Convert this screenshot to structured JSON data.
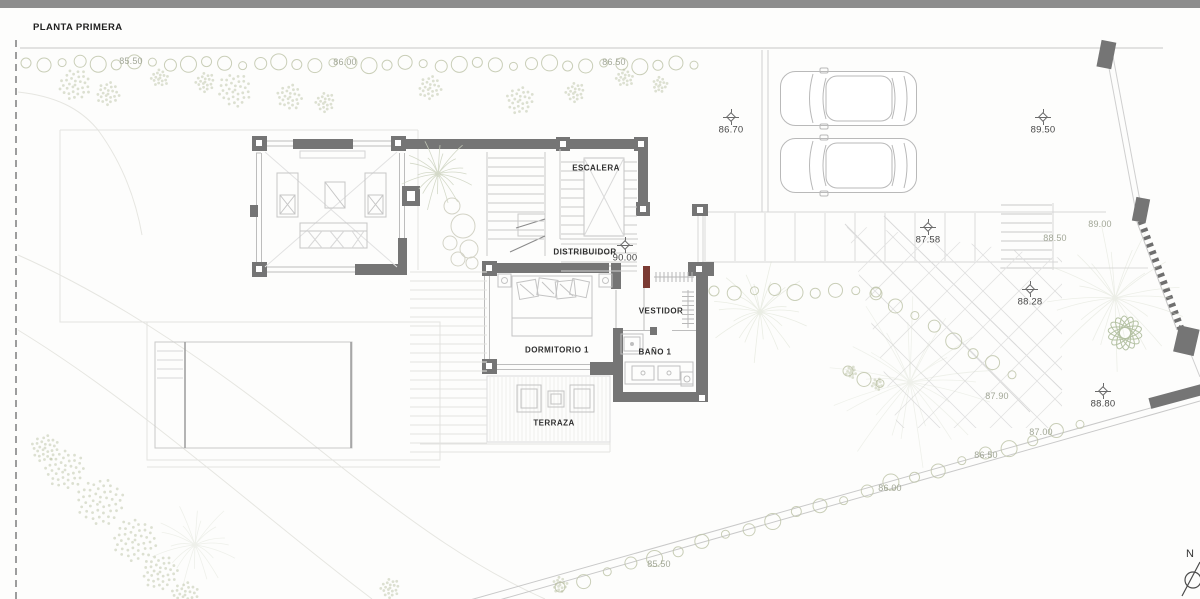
{
  "page": {
    "title": "PLANTA PRIMERA"
  },
  "compass": {
    "label": "N"
  },
  "colors": {
    "topbar": "#8d8d8d",
    "wall": "#757575",
    "thin_line": "#c9c9c9",
    "vegetation": "#b9c0a3",
    "wardrobe_accent": "#7b3b33",
    "label_dark": "#474747",
    "label_light": "#a2a797"
  },
  "rooms": [
    {
      "id": "escalera",
      "label": "ESCALERA",
      "x": 596,
      "y": 168
    },
    {
      "id": "distribuidor",
      "label": "DISTRIBUIDOR",
      "x": 585,
      "y": 252
    },
    {
      "id": "dormitorio-1",
      "label": "DORMITORIO 1",
      "x": 557,
      "y": 350
    },
    {
      "id": "vestidor",
      "label": "VESTIDOR",
      "x": 661,
      "y": 311
    },
    {
      "id": "bano-1",
      "label": "BAÑO 1",
      "x": 655,
      "y": 352
    },
    {
      "id": "terraza",
      "label": "TERRAZA",
      "x": 554,
      "y": 423
    }
  ],
  "elevation_labels": [
    {
      "value": "85.50",
      "x": 131,
      "y": 61,
      "tone": "light",
      "cross": false
    },
    {
      "value": "86.00",
      "x": 345,
      "y": 62,
      "tone": "light",
      "cross": false
    },
    {
      "value": "86.50",
      "x": 614,
      "y": 62,
      "tone": "light",
      "cross": false
    },
    {
      "value": "86.70",
      "x": 731,
      "y": 130,
      "tone": "dark",
      "cross": true
    },
    {
      "value": "89.50",
      "x": 1043,
      "y": 130,
      "tone": "dark",
      "cross": true
    },
    {
      "value": "89.00",
      "x": 1100,
      "y": 224,
      "tone": "light",
      "cross": false
    },
    {
      "value": "87.58",
      "x": 928,
      "y": 240,
      "tone": "dark",
      "cross": true
    },
    {
      "value": "88.50",
      "x": 1055,
      "y": 238,
      "tone": "light",
      "cross": false
    },
    {
      "value": "90.00",
      "x": 625,
      "y": 258,
      "tone": "dark",
      "cross": true
    },
    {
      "value": "88.28",
      "x": 1030,
      "y": 302,
      "tone": "dark",
      "cross": true
    },
    {
      "value": "88.80",
      "x": 1103,
      "y": 404,
      "tone": "dark",
      "cross": true
    },
    {
      "value": "87.90",
      "x": 997,
      "y": 396,
      "tone": "light",
      "cross": false
    },
    {
      "value": "87.00",
      "x": 1041,
      "y": 432,
      "tone": "light",
      "cross": false
    },
    {
      "value": "86.50",
      "x": 986,
      "y": 455,
      "tone": "light",
      "cross": false
    },
    {
      "value": "86.00",
      "x": 890,
      "y": 488,
      "tone": "light",
      "cross": false
    },
    {
      "value": "85.50",
      "x": 659,
      "y": 564,
      "tone": "light",
      "cross": false
    }
  ]
}
